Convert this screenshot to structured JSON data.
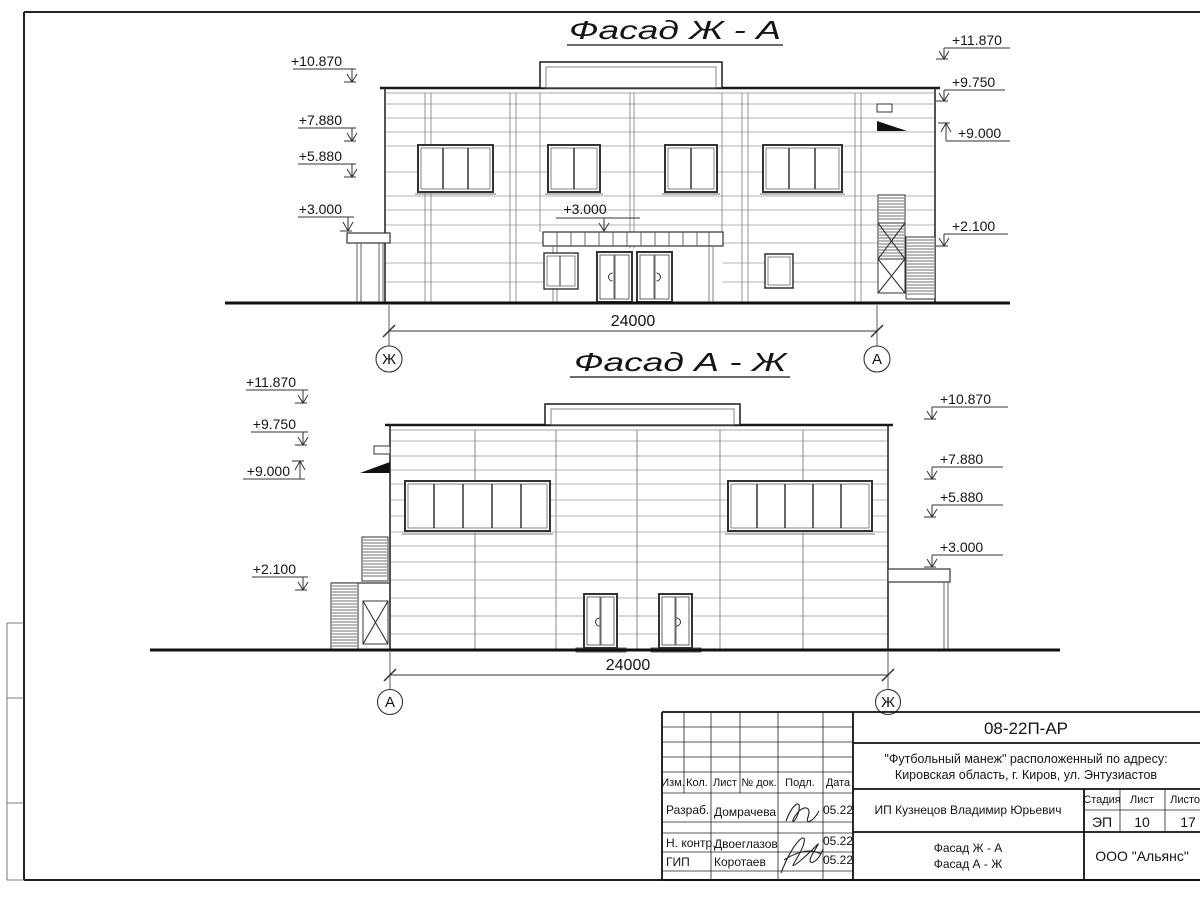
{
  "drawing": {
    "facade_top": {
      "title": "Фасад Ж - А",
      "marks_left": [
        "+10.870",
        "+7.880",
        "+5.880",
        "+3.000"
      ],
      "marks_right": [
        "+11.870",
        "+9.750",
        "+9.000",
        "+2.100"
      ],
      "canopy_mark": "+3.000",
      "dimension": "24000",
      "axis_left": "Ж",
      "axis_right": "А"
    },
    "facade_bottom": {
      "title": "Фасад А - Ж",
      "marks_left": [
        "+11.870",
        "+9.750",
        "+9.000",
        "+2.100"
      ],
      "marks_right": [
        "+10.870",
        "+7.880",
        "+5.880",
        "+3.000"
      ],
      "dimension": "24000",
      "axis_left": "А",
      "axis_right": "Ж"
    }
  },
  "title_block": {
    "doc_number": "08-22П-АР",
    "project_address_line1": "\"Футбольный манеж\" расположенный по адресу:",
    "project_address_line2": "Кировская область, г. Киров, ул. Энтузиастов",
    "client": "ИП Кузнецов Владимир Юрьевич",
    "sheet_name_line1": "Фасад Ж - А",
    "sheet_name_line2": "Фасад А - Ж",
    "organization": "ООО \"Альянс\"",
    "columns": {
      "izm": "Изм.",
      "kol": "Кол.",
      "list": "Лист",
      "doc_no": "№ док.",
      "podp": "Подл.",
      "date": "Дата"
    },
    "stage_header": {
      "stage": "Стадия",
      "sheet": "Лист",
      "sheets": "Листов"
    },
    "stage_values": {
      "stage": "ЭП",
      "sheet": "10",
      "sheets": "17"
    },
    "signature_rows": [
      {
        "role": "Разраб.",
        "name": "Домрачева",
        "date": "05.22"
      },
      {
        "role": "Н. контр.",
        "name": "Двоеглазов",
        "date": "05.22"
      },
      {
        "role": "ГИП",
        "name": "Коротаев",
        "date": "05.22"
      }
    ]
  }
}
